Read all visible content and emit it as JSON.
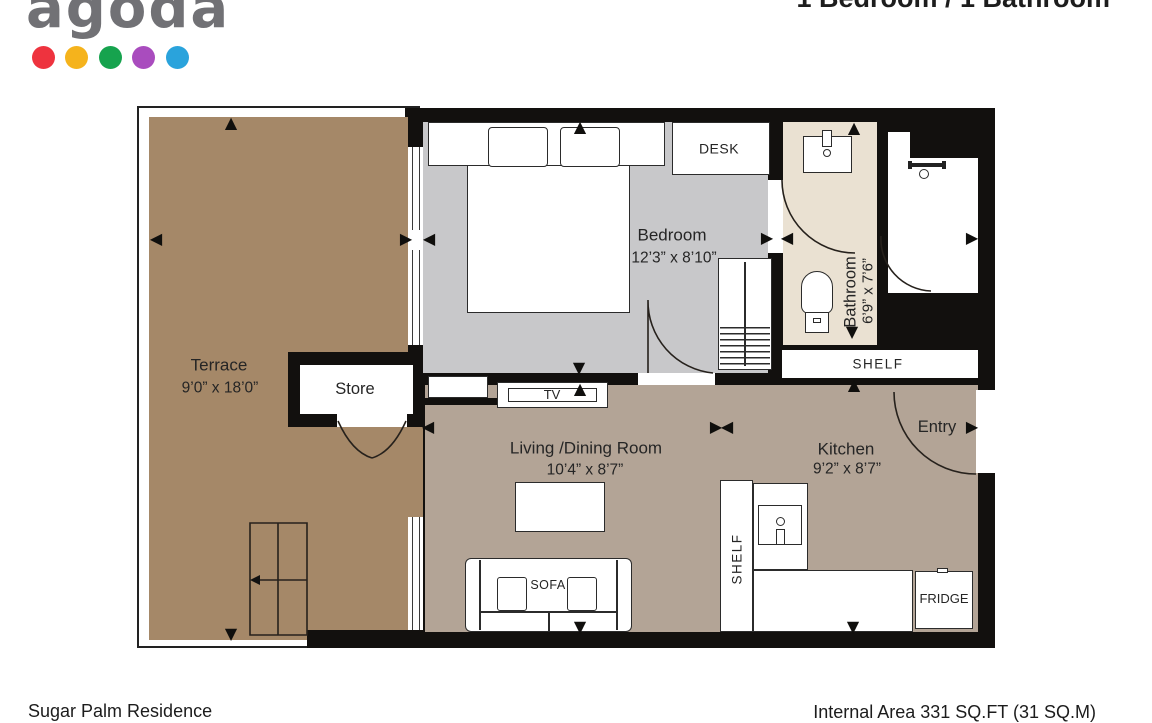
{
  "logo": {
    "text": "agoda",
    "dot_colors": [
      "#ee333e",
      "#f5b31c",
      "#16a34e",
      "#a94cbe",
      "#2aa3dc"
    ]
  },
  "header": {
    "title": "1 Bedroom / 1 Bathroom"
  },
  "floorplan": {
    "colors": {
      "wall": "#12100e",
      "terrace": "#a58868",
      "bedroom": "#c8c8ca",
      "bathroom": "#eae1d2",
      "living": "#b3a496"
    },
    "rooms": {
      "terrace": {
        "name": "Terrace",
        "dims": "9’0” x 18’0”"
      },
      "bedroom": {
        "name": "Bedroom",
        "dims": "12’3” x 8’10”"
      },
      "bathroom": {
        "name": "Bathroom",
        "dims": "6’9” x 7’6”"
      },
      "living": {
        "name": "Living /Dining Room",
        "dims": "10’4” x 8’7”"
      },
      "kitchen": {
        "name": "Kitchen",
        "dims": "9’2” x 8’7”"
      }
    },
    "labels": {
      "store": "Store",
      "desk": "DESK",
      "tv": "TV",
      "sofa": "SOFA",
      "shelf": "SHELF",
      "shelf_kitchen": "SHELF",
      "fridge": "FRIDGE",
      "entry": "Entry"
    }
  },
  "footer": {
    "property_name": "Sugar Palm Residence",
    "internal_area": "Internal Area 331 SQ.FT (31 SQ.M)"
  }
}
